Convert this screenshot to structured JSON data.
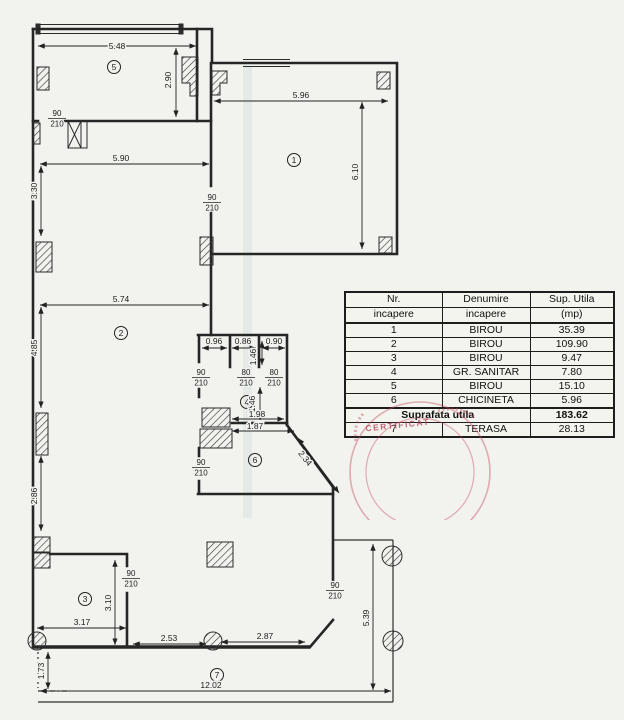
{
  "page": {
    "background": "#f2f2ee",
    "ink": "#222222",
    "stamp_red": "#c0485e"
  },
  "plan": {
    "rooms": [
      {
        "n": "5",
        "x": 114,
        "y": 67
      },
      {
        "n": "1",
        "x": 294,
        "y": 160
      },
      {
        "n": "2",
        "x": 121,
        "y": 333
      },
      {
        "n": "4",
        "x": 247,
        "y": 402
      },
      {
        "n": "6",
        "x": 255,
        "y": 460
      },
      {
        "n": "3",
        "x": 85,
        "y": 599
      },
      {
        "n": "7",
        "x": 217,
        "y": 675
      }
    ],
    "dims": [
      {
        "t": "5.48",
        "x": 117,
        "y": 49
      },
      {
        "t": "2.90",
        "x": 171,
        "y": 80,
        "r": -90
      },
      {
        "t": "5.90",
        "x": 121,
        "y": 161
      },
      {
        "t": "3.30",
        "x": 37,
        "y": 191,
        "r": -90
      },
      {
        "t": "5.96",
        "x": 301,
        "y": 98
      },
      {
        "t": "6.10",
        "x": 358,
        "y": 172,
        "r": -90
      },
      {
        "t": "5.74",
        "x": 121,
        "y": 302
      },
      {
        "t": "4.85",
        "x": 37,
        "y": 348,
        "r": -90
      },
      {
        "t": "2.86",
        "x": 37,
        "y": 496,
        "r": -90
      },
      {
        "t": "0.96",
        "x": 214,
        "y": 344
      },
      {
        "t": "0.86",
        "x": 243,
        "y": 344
      },
      {
        "t": "0.90",
        "x": 274,
        "y": 344
      },
      {
        "t": "1.46",
        "x": 256,
        "y": 357,
        "r": -90
      },
      {
        "t": "1.46",
        "x": 255,
        "y": 404,
        "r": -90
      },
      {
        "t": "1.98",
        "x": 257,
        "y": 417
      },
      {
        "t": "1.87",
        "x": 255,
        "y": 429
      },
      {
        "t": "2.34",
        "x": 303,
        "y": 460,
        "r": 52
      },
      {
        "t": "3.10",
        "x": 111,
        "y": 603,
        "r": -90
      },
      {
        "t": "3.17",
        "x": 82,
        "y": 625
      },
      {
        "t": "2.53",
        "x": 169,
        "y": 641
      },
      {
        "t": "2.87",
        "x": 265,
        "y": 639
      },
      {
        "t": "1.73",
        "x": 44,
        "y": 671,
        "r": -90
      },
      {
        "t": "12.02",
        "x": 211,
        "y": 688
      },
      {
        "t": "5.39",
        "x": 369,
        "y": 618,
        "r": -90
      }
    ],
    "doors": [
      {
        "w": "90",
        "h": "210",
        "x": 57,
        "y": 116
      },
      {
        "w": "90",
        "h": "210",
        "x": 212,
        "y": 200
      },
      {
        "w": "90",
        "h": "210",
        "x": 201,
        "y": 375
      },
      {
        "w": "80",
        "h": "210",
        "x": 246,
        "y": 375
      },
      {
        "w": "80",
        "h": "210",
        "x": 274,
        "y": 375
      },
      {
        "w": "90",
        "h": "210",
        "x": 201,
        "y": 465
      },
      {
        "w": "90",
        "h": "210",
        "x": 131,
        "y": 576
      },
      {
        "w": "90",
        "h": "210",
        "x": 335,
        "y": 588
      }
    ]
  },
  "table": {
    "headers": [
      [
        "Nr.",
        "Denumire",
        "Sup. Utila"
      ],
      [
        "incapere",
        "incapere",
        "(mp)"
      ]
    ],
    "rows": [
      [
        "1",
        "BIROU",
        "35.39"
      ],
      [
        "2",
        "BIROU",
        "109.90"
      ],
      [
        "3",
        "BIROU",
        "9.47"
      ],
      [
        "4",
        "GR. SANITAR",
        "7.80"
      ],
      [
        "5",
        "BIROU",
        "15.10"
      ],
      [
        "6",
        "CHICINETA",
        "5.96"
      ]
    ],
    "total_label": "Suprafata utila",
    "total_value": "183.62",
    "terasa_row": [
      "7",
      "TERASA",
      "28.13"
    ]
  },
  "stamp": {
    "text": "CERTIFICAT",
    "color": "#c0485e"
  }
}
